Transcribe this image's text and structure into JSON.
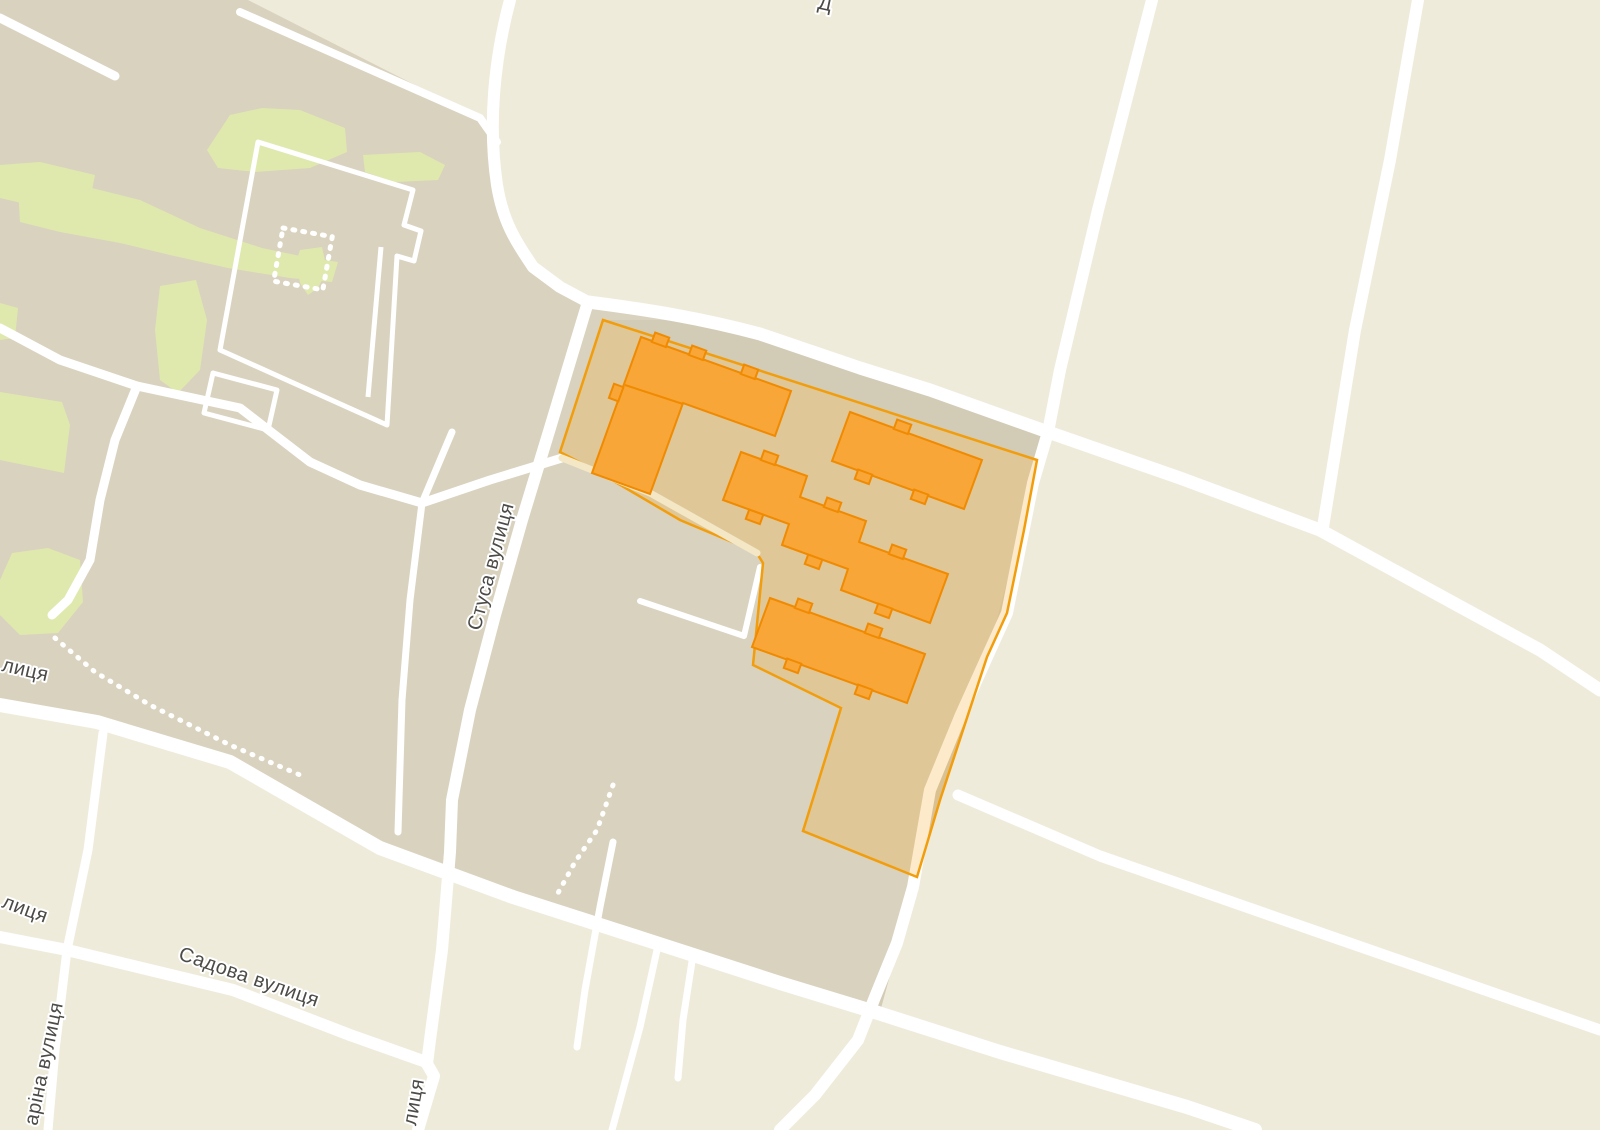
{
  "map": {
    "kind": "street map with highlighted land parcel and buildings",
    "labels": {
      "street_stusa": "Стуса вулиця",
      "street_sadova": "Садова вулиця",
      "street_partial_mid_left": "лиця",
      "street_partial_lower_left": "лиця",
      "street_partial_bottom": "лиця",
      "street_partial_gagarina": "аріна вулиця",
      "street_partial_top": "Д"
    },
    "selection": {
      "highlighted_parcels": 1,
      "highlighted_buildings": 4
    },
    "colors": {
      "base": "#EFEBDB",
      "district": "#D9D2BF",
      "shadow_band": "#D2CBB6",
      "park": "#DFE9AE",
      "road": "#FFFFFF",
      "parcel_fill": "rgba(244,158,12,0.22)",
      "parcel_stroke": "#F29D0B",
      "building_fill": "#F9A638",
      "building_stroke": "#F08A00",
      "label_text": "#4D4B47",
      "inner_path": "#F3E7C5"
    }
  }
}
